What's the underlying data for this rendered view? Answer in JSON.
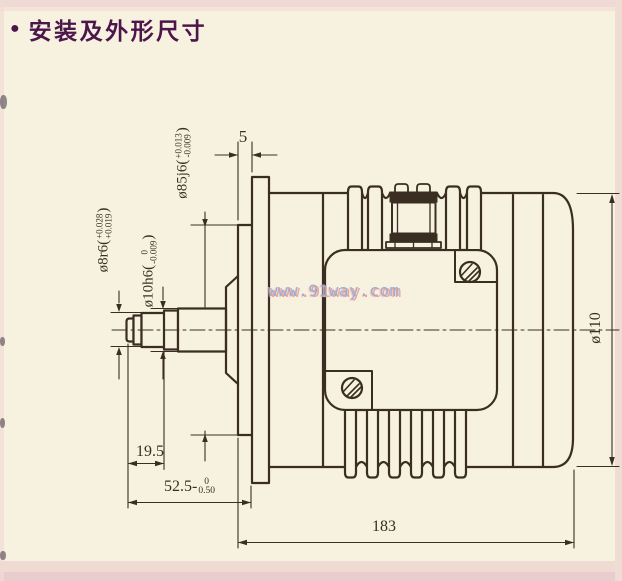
{
  "header": {
    "bullet": "●",
    "title": "安装及外形尺寸"
  },
  "watermark": {
    "text": "www.91way.com"
  },
  "drawing": {
    "kind": "motor outline and mounting dimension drawing, side view",
    "dims": {
      "spigot_len": "5",
      "shaft_tip_len": "19.5",
      "total_shaft_len": {
        "prefix": "52.5-",
        "tol_top": "0",
        "tol_bottom": "0.50",
        "suffix": ""
      },
      "overall_len": "183",
      "body_dia": "ø110",
      "tip_dia": {
        "prefix": "ø8r6(",
        "tol_top": "+0.028",
        "tol_bottom": "+0.019",
        "suffix": ")"
      },
      "shaft_dia": {
        "prefix": "ø10h6(",
        "tol_top": "0",
        "tol_bottom": "-0.009",
        "suffix": ")"
      },
      "spigot_dia": {
        "prefix": "ø85j6(",
        "tol_top": "+0.013",
        "tol_bottom": "-0.009",
        "suffix": ")"
      }
    }
  },
  "colors": {
    "paper": "#f7f1e0",
    "ink": "#3a2e22",
    "title_text": "#4c164a",
    "watermark_blue": "#96aed9",
    "watermark_halo": "#e8a39c",
    "edge_pink_top": "#eed9d4",
    "edge_pink_bottom": "#e9cccd",
    "edge_pink_soft": "#f0dbd3",
    "edge_pink_right": "#efdcd3"
  }
}
